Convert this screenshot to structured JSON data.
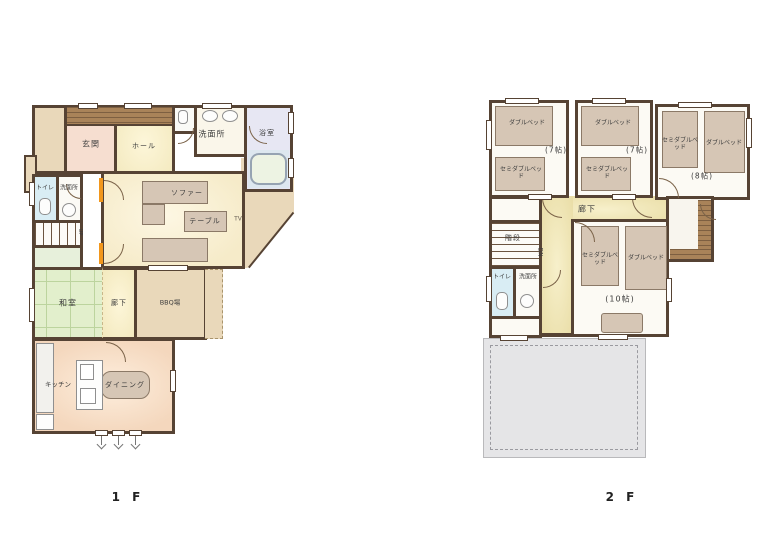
{
  "colors": {
    "wall": "#564334",
    "terrace_beige": "#e9d8ba",
    "genkan_pink": "#f6ded0",
    "tatami_green": "#e2efcc",
    "corridor_yellow": "#ece0ae",
    "kitchen_orange": "#f4d7bd",
    "bed_tan": "#d6c6b5",
    "toilet_blue": "#d9edf4",
    "bathroom_lavender": "#e7e7f3",
    "roof_gray": "#e5e5e7",
    "door_orange": "#f2971c"
  },
  "f1": {
    "floor_label": "1 F",
    "genkan": "玄関",
    "hall": "ホール",
    "senmenjo_top": "洗面所",
    "yokushitsu": "浴室",
    "toilet": "トイレ",
    "senmenjo": "洗面所",
    "up": "UP",
    "sofa": "ソファー",
    "table": "テーブル",
    "tv": "TV",
    "washitsu": "和室",
    "rouka": "廊下",
    "bbq": "BBQ場",
    "kitchen": "キッチン",
    "dining": "ダイニング"
  },
  "f2": {
    "floor_label": "2 F",
    "rouka": "廊下",
    "kaidan": "階段",
    "dn": "DN",
    "toilet": "トイレ",
    "senmenjo": "洗面所",
    "r1_bed1": "ダブルベッド",
    "r1_bed2": "セミダブルベッド",
    "r1_size": "(7帖)",
    "r2_bed1": "ダブルベッド",
    "r2_bed2": "セミダブルベッド",
    "r2_size": "(7帖)",
    "r3_bed1": "セミダブルベッド",
    "r3_bed2": "ダブルベッド",
    "r3_size": "(8帖)",
    "r4_bed1": "セミダブルベッド",
    "r4_bed2": "ダブルベッド",
    "r4_size": "(10帖)"
  }
}
